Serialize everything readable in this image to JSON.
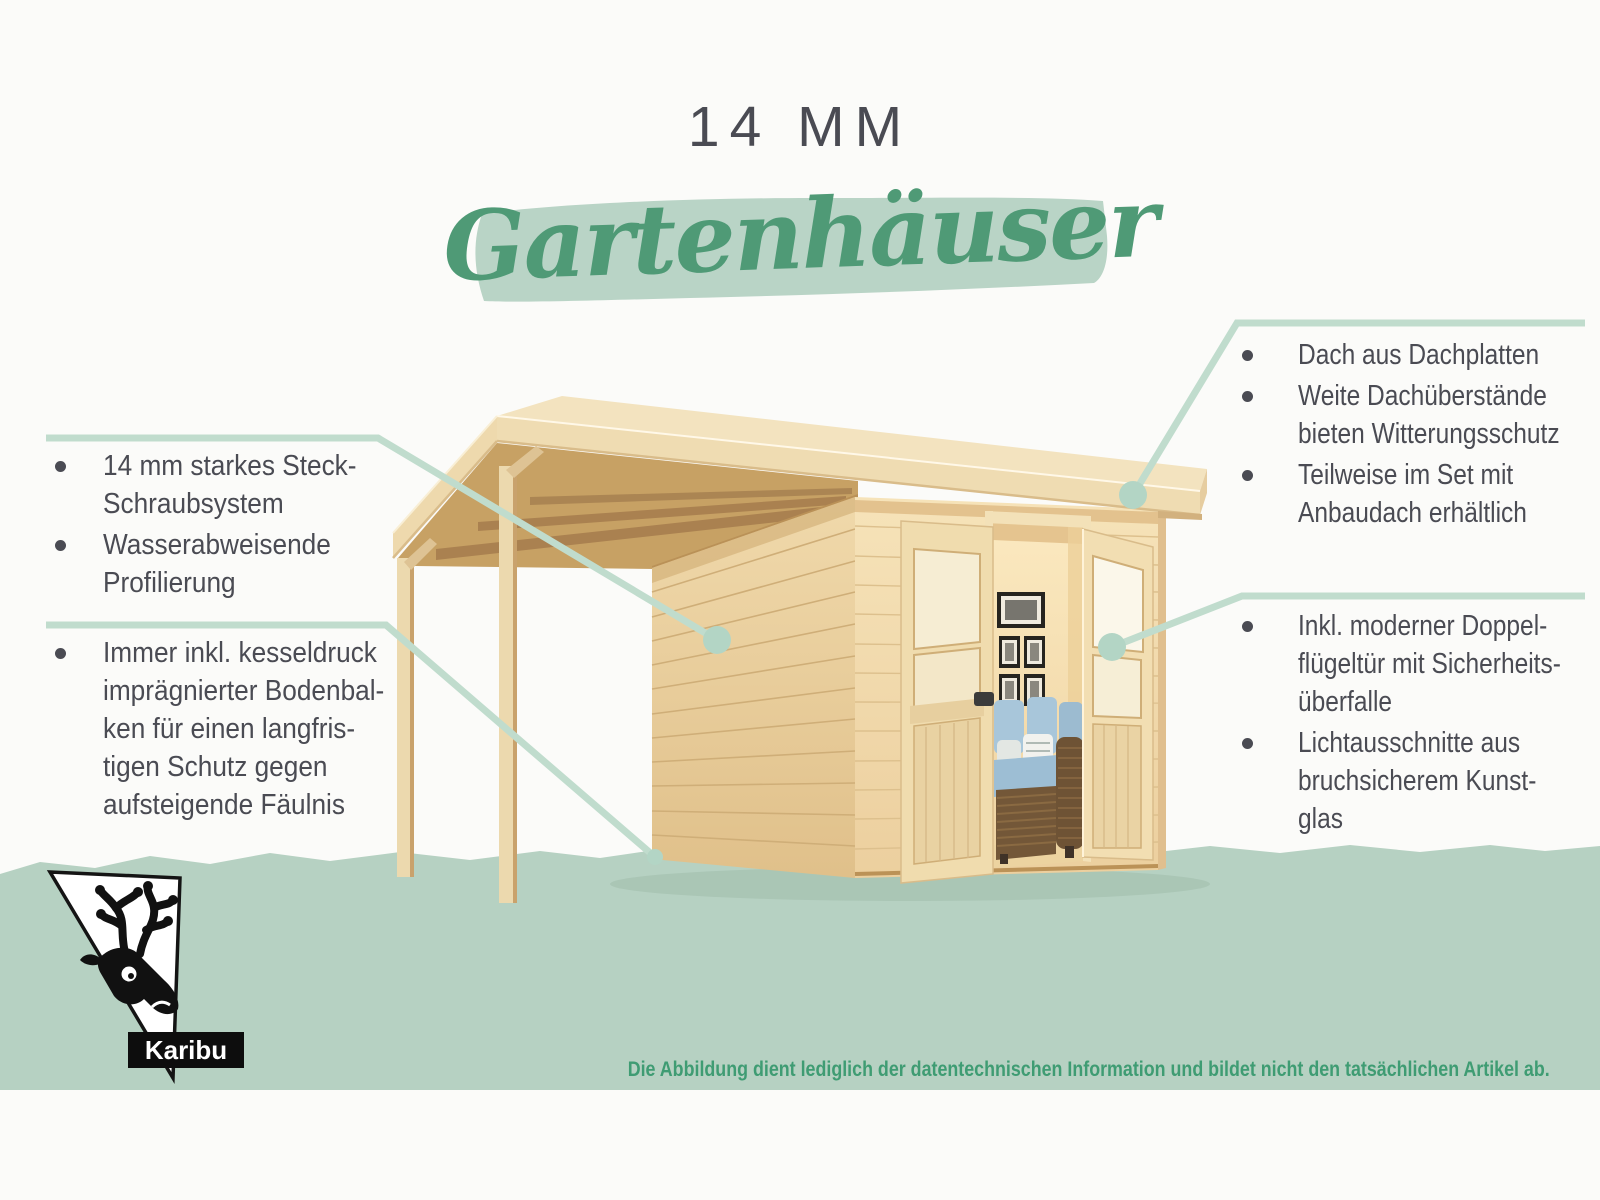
{
  "title": {
    "line1": "14 MM",
    "line2": "Gartenhäuser"
  },
  "left_panel": {
    "group1": {
      "bullets": [
        {
          "text": "14 mm starkes Steck-\nSchraubsystem"
        },
        {
          "text": "Wasserabweisende\nProfilierung"
        }
      ]
    },
    "group2": {
      "bullets": [
        {
          "text": "Immer inkl. kesseldruck\nimprägnierter Bodenbal-\nken für einen langfris-\ntigen Schutz gegen\naufsteigende Fäulnis"
        }
      ]
    }
  },
  "right_panel": {
    "group1": {
      "bullets": [
        {
          "text": "Dach aus Dachplatten"
        },
        {
          "text": "Weite Dachüberstände\nbieten Witterungsschutz"
        },
        {
          "text": "Teilweise im Set mit\nAnbaudach erhältlich"
        }
      ]
    },
    "group2": {
      "bullets": [
        {
          "text": "Inkl. moderner Doppel-\nflügeltür mit Sicherheits-\nüberfalle"
        },
        {
          "text": "Lichtausschnitte aus\nbruchsicherem Kunst-\nglas"
        }
      ]
    }
  },
  "footer": {
    "brand": "Karibu",
    "disclaimer": "Die Abbildung dient lediglich der datentechnischen Information und bildet nicht den tatsächlichen Artikel ab."
  },
  "colors": {
    "accent_green": "#4f9a76",
    "band_sage": "#b6d1c2",
    "brush_sage": "#b9d4c6",
    "callout_line": "#c0dccd",
    "callout_dot": "#b3d5c5",
    "text_dark": "#4a4b53",
    "disclaimer_green": "#3f9c73",
    "wood_light": "#f3e3bf",
    "wood_mid": "#ecd5a7",
    "wood_dark": "#c7a164",
    "sofa_blue": "#a8c6da"
  }
}
